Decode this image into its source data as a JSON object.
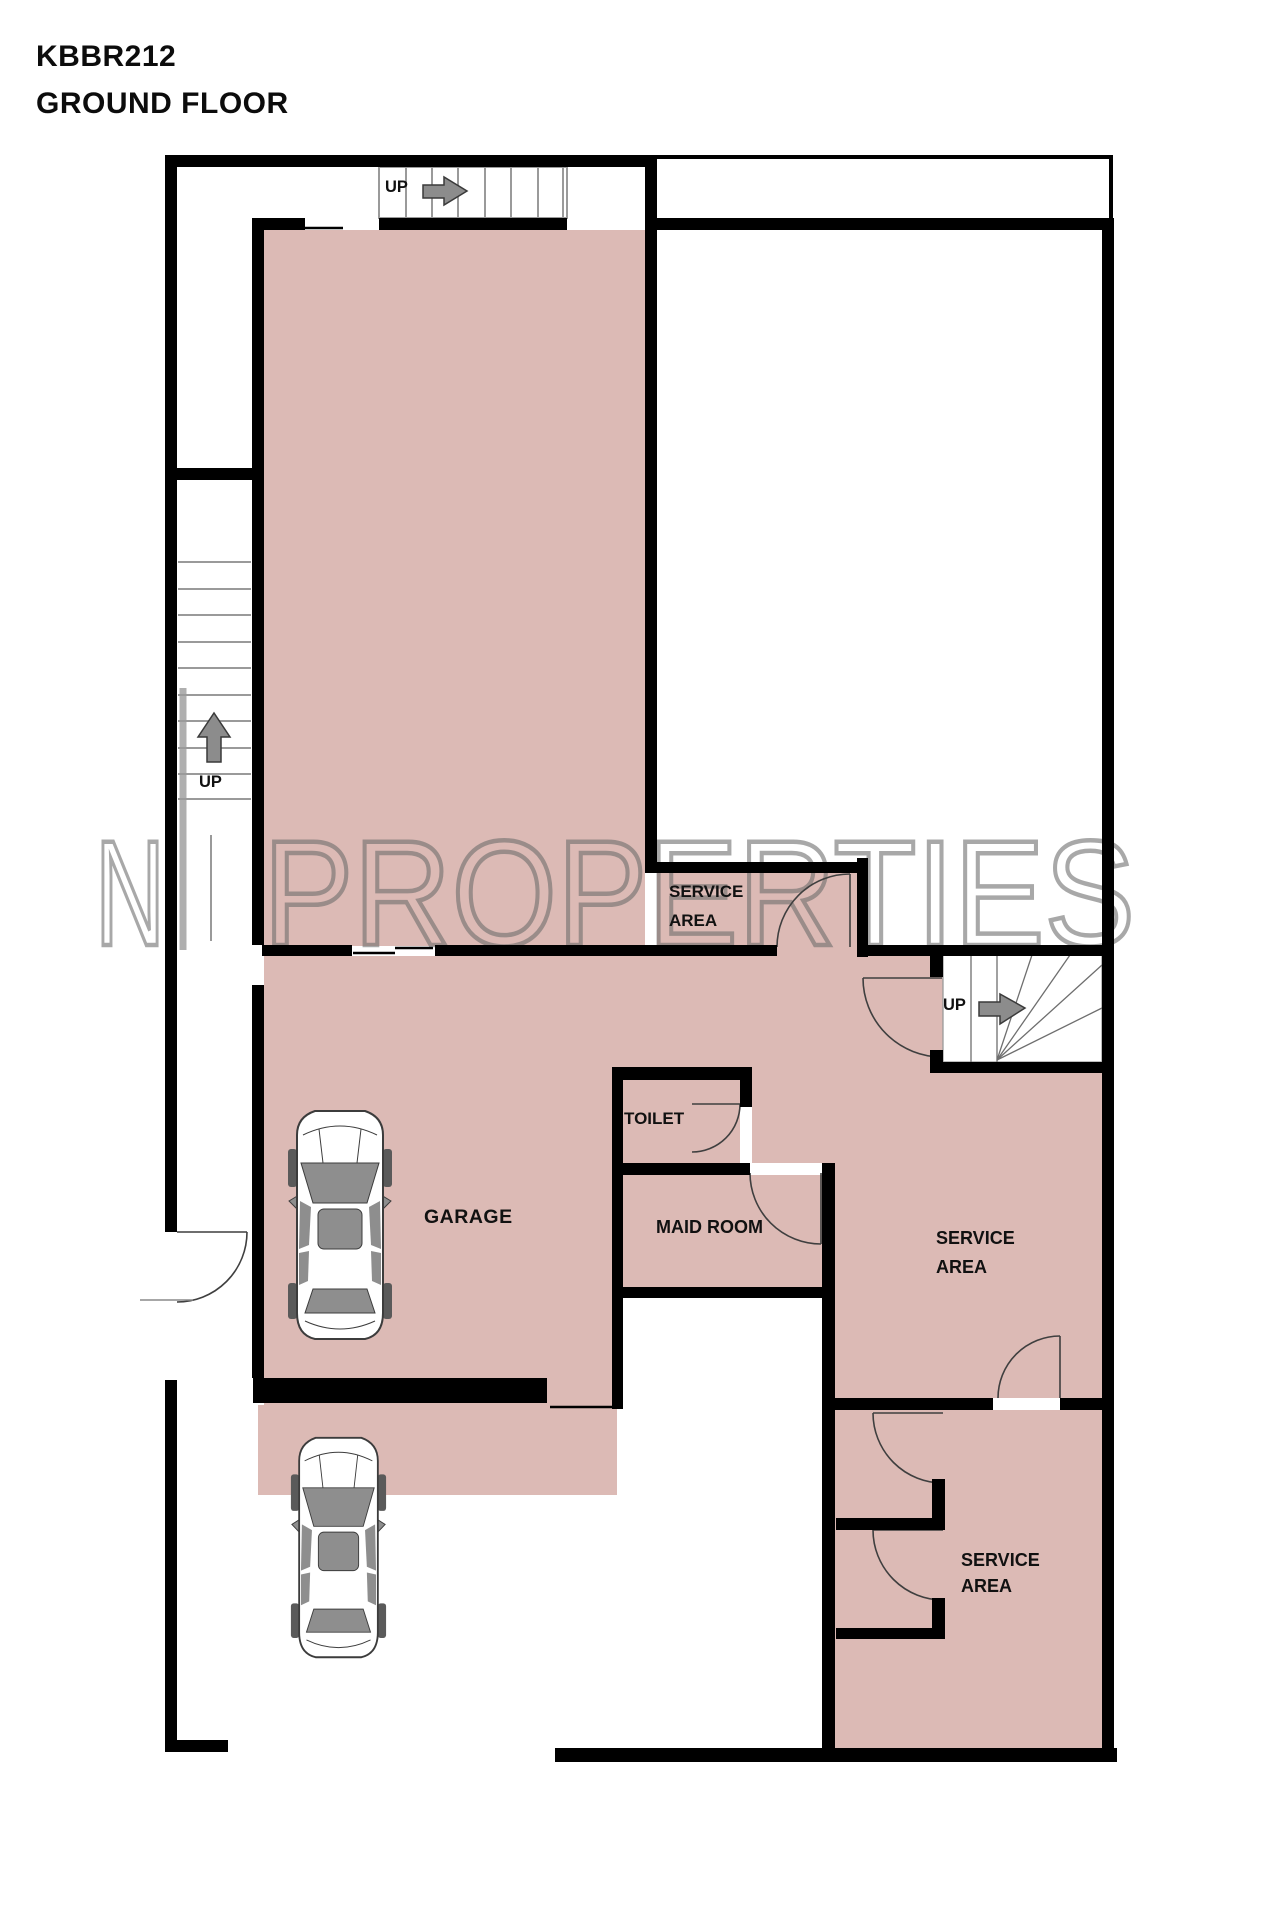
{
  "title": {
    "code": "KBBR212",
    "floor": "GROUND FLOOR"
  },
  "watermark": {
    "letter": "N",
    "word": "PROPERTIES"
  },
  "rooms": {
    "garage": {
      "label": "GARAGE"
    },
    "toilet": {
      "label": "TOILET"
    },
    "maid": {
      "label": "MAID ROOM"
    },
    "service1": {
      "line1": "SERVICE",
      "line2": "AREA"
    },
    "service2": {
      "line1": "SERVICE",
      "line2": "AREA"
    },
    "service3": {
      "line1": "SERVICE",
      "line2": "AREA"
    }
  },
  "stairs": {
    "top": {
      "label": "UP",
      "direction": "right"
    },
    "left": {
      "label": "UP",
      "direction": "up"
    },
    "right": {
      "label": "UP",
      "direction": "right"
    }
  },
  "colors": {
    "room_fill": "#dcbab5",
    "wall": "#000000",
    "tread_line": "#9a9a9a",
    "arrow_fill": "#8c8c8c",
    "door_line": "#3f3f3f",
    "watermark_gray": "#6b6b6b"
  }
}
